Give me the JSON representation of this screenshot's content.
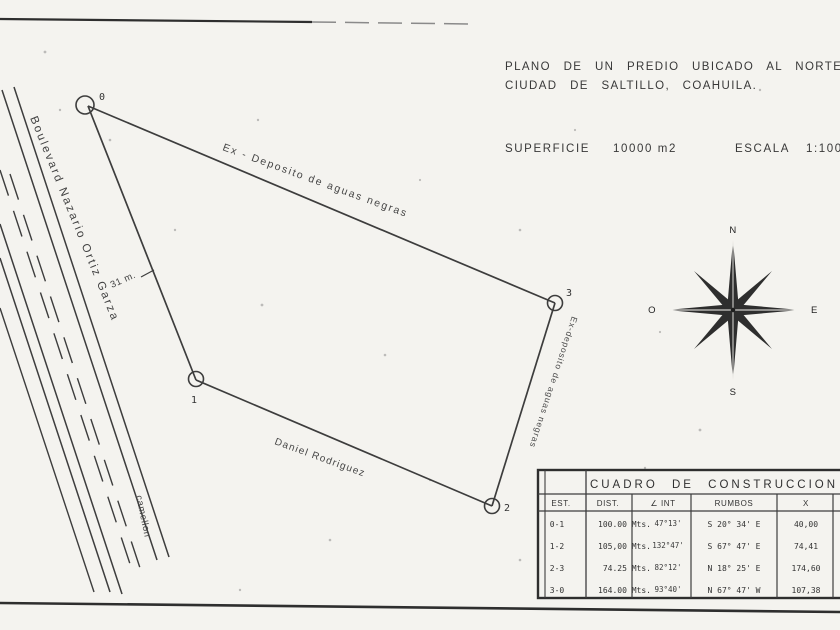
{
  "header": {
    "title_line1": "PLANO DE UN PREDIO UBICADO AL NORTE DE LA",
    "title_line2": "CIUDAD DE SALTILLO, COAHUILA.",
    "superficie_label": "SUPERFICIE",
    "superficie_value": "10000 m2",
    "escala_label": "ESCALA",
    "escala_value": "1:1000"
  },
  "compass": {
    "north": "N",
    "south": "S",
    "east": "E",
    "west": "O"
  },
  "road": {
    "name": "Boulevard Nazario Ortiz Garza",
    "median": "camellon",
    "width": "31 m."
  },
  "parcel": {
    "vertex_labels": [
      "0",
      "1",
      "2",
      "3"
    ],
    "edge_labels": {
      "top": "Ex - Deposito de aguas negras",
      "right": "Ex-deposito de aguas negras",
      "bottom": "Daniel Rodriguez"
    }
  },
  "table": {
    "title": "CUADRO DE CONSTRUCCION",
    "headers": {
      "est": "EST.",
      "dist": "DIST.",
      "ang": "∠ INT",
      "rumbos": "RUMBOS",
      "x": "X"
    },
    "rows": [
      {
        "est": "0-1",
        "dist": "100.00 Mts.",
        "ang": "47°13'",
        "rumbo": "S 20° 34' E",
        "x": "40,00"
      },
      {
        "est": "1-2",
        "dist": "105,00 Mts.",
        "ang": "132°47'",
        "rumbo": "S 67° 47' E",
        "x": "74,41"
      },
      {
        "est": "2-3",
        "dist": "74.25 Mts.",
        "ang": "82°12'",
        "rumbo": "N 18° 25' E",
        "x": "174,60"
      },
      {
        "est": "3-0",
        "dist": "164.00 Mts.",
        "ang": "93°40'",
        "rumbo": "N 67° 47' W",
        "x": "107,38"
      }
    ]
  }
}
